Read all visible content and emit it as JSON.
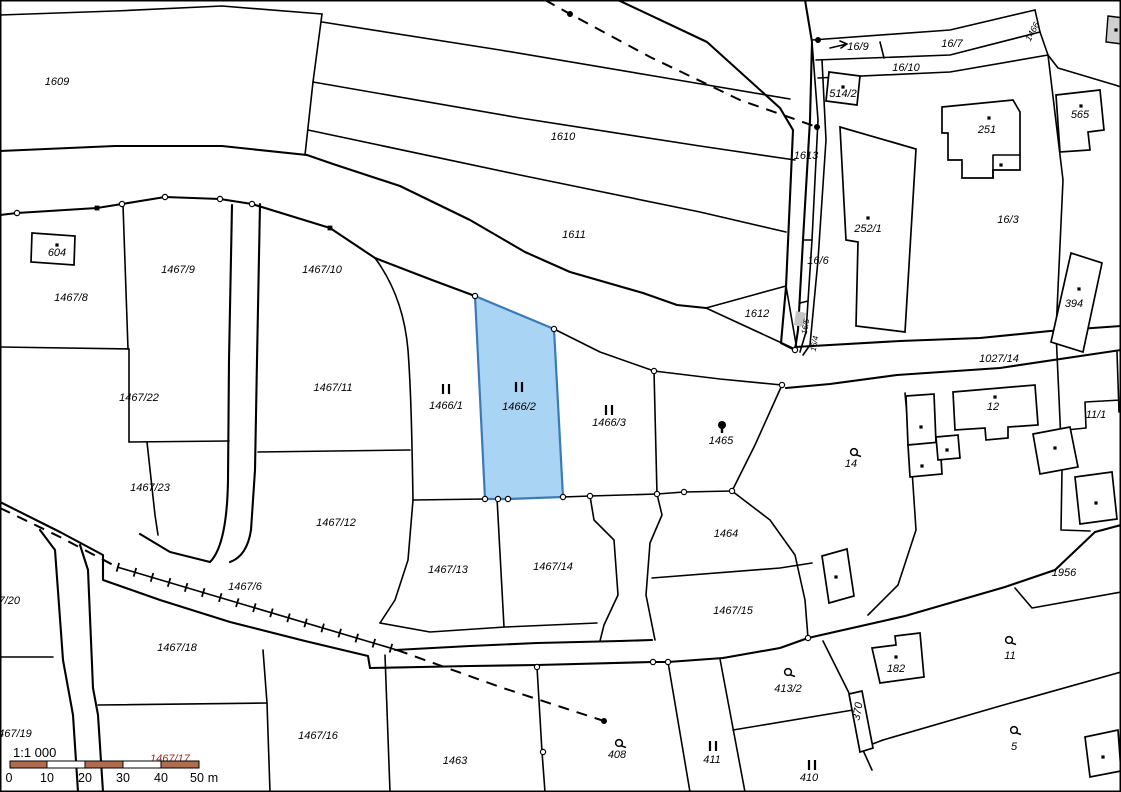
{
  "map": {
    "type": "cadastral-map",
    "background_color": "#ffffff",
    "line_color": "#000000",
    "highlight_parcel": {
      "label": "1466/2",
      "fill": "#a9d4f4",
      "stroke": "#3b7ab8"
    },
    "scale_bar": {
      "ratio_label": "1:1 000",
      "ticks": [
        "0",
        "10",
        "20",
        "30",
        "40",
        "50"
      ],
      "unit": "m",
      "bar_color": "#b26b4c",
      "bar_alt_color": "#ffffff",
      "hidden_label": "1467/17",
      "hidden_label_color": "#9b2c20"
    },
    "labels": [
      {
        "t": "1609",
        "x": 57,
        "y": 85
      },
      {
        "t": "1610",
        "x": 563,
        "y": 140
      },
      {
        "t": "1611",
        "x": 574,
        "y": 238
      },
      {
        "t": "16/9",
        "x": 858,
        "y": 50
      },
      {
        "t": "16/7",
        "x": 952,
        "y": 47
      },
      {
        "t": "16/10",
        "x": 906,
        "y": 71
      },
      {
        "t": "514/2",
        "x": 843,
        "y": 97
      },
      {
        "t": "1613",
        "x": 806,
        "y": 159
      },
      {
        "t": "252/1",
        "x": 868,
        "y": 232
      },
      {
        "t": "251",
        "x": 987,
        "y": 133
      },
      {
        "t": "565",
        "x": 1080,
        "y": 118
      },
      {
        "t": "16/3",
        "x": 1008,
        "y": 223
      },
      {
        "t": "16/6",
        "x": 818,
        "y": 264
      },
      {
        "t": "604",
        "x": 57,
        "y": 256
      },
      {
        "t": "1467/8",
        "x": 71,
        "y": 301
      },
      {
        "t": "1467/9",
        "x": 178,
        "y": 273
      },
      {
        "t": "1467/10",
        "x": 322,
        "y": 273
      },
      {
        "t": "1467/22",
        "x": 139,
        "y": 401
      },
      {
        "t": "1467/11",
        "x": 333,
        "y": 391
      },
      {
        "t": "1467/23",
        "x": 150,
        "y": 491
      },
      {
        "t": "1467/12",
        "x": 336,
        "y": 526
      },
      {
        "t": "1466/1",
        "x": 446,
        "y": 409
      },
      {
        "t": "1466/2",
        "x": 519,
        "y": 410
      },
      {
        "t": "1466/3",
        "x": 609,
        "y": 426
      },
      {
        "t": "1465",
        "x": 721,
        "y": 444
      },
      {
        "t": "1612",
        "x": 757,
        "y": 317
      },
      {
        "t": "1027/14",
        "x": 999,
        "y": 362
      },
      {
        "t": "12",
        "x": 993,
        "y": 410
      },
      {
        "t": "11/1",
        "x": 1096,
        "y": 418
      },
      {
        "t": "14",
        "x": 851,
        "y": 467
      },
      {
        "t": "394",
        "x": 1074,
        "y": 307
      },
      {
        "t": "1464",
        "x": 726,
        "y": 537
      },
      {
        "t": "1467/15",
        "x": 733,
        "y": 614
      },
      {
        "t": "1956",
        "x": 1064,
        "y": 576
      },
      {
        "t": "1467/6",
        "x": 245,
        "y": 590
      },
      {
        "t": "1467/18",
        "x": 177,
        "y": 651
      },
      {
        "t": "1467/20",
        "x": 20,
        "y": 604,
        "a": "end"
      },
      {
        "t": "1467/19",
        "x": -8,
        "y": 737,
        "a": "start"
      },
      {
        "t": "1467/16",
        "x": 318,
        "y": 739
      },
      {
        "t": "1467/13",
        "x": 448,
        "y": 573
      },
      {
        "t": "1467/14",
        "x": 553,
        "y": 570
      },
      {
        "t": "1463",
        "x": 455,
        "y": 764
      },
      {
        "t": "408",
        "x": 617,
        "y": 758
      },
      {
        "t": "411",
        "x": 712,
        "y": 763
      },
      {
        "t": "410",
        "x": 809,
        "y": 781
      },
      {
        "t": "413/2",
        "x": 788,
        "y": 692
      },
      {
        "t": "182",
        "x": 896,
        "y": 672
      },
      {
        "t": "11",
        "x": 1010,
        "y": 659
      },
      {
        "t": "5",
        "x": 1014,
        "y": 750
      },
      {
        "t": "370",
        "x": 861,
        "y": 712,
        "r": -80
      },
      {
        "t": "1466",
        "x": 1035,
        "y": 33,
        "r": -62,
        "c": "#8f8f8f",
        "s": 9
      },
      {
        "t": "16/5",
        "x": 808,
        "y": 327,
        "r": -80,
        "c": "#8f8f8f",
        "s": 8
      },
      {
        "t": "16/4",
        "x": 817,
        "y": 344,
        "r": -80,
        "c": "#8f8f8f",
        "s": 8
      }
    ],
    "symbols": {
      "grassland_two_bars": [
        [
          446,
          389
        ],
        [
          519,
          387
        ],
        [
          609,
          410
        ],
        [
          713,
          746
        ],
        [
          812,
          765
        ]
      ],
      "tree": [
        [
          854,
          452
        ],
        [
          619,
          743
        ],
        [
          788,
          672
        ],
        [
          1009,
          640
        ],
        [
          1014,
          730
        ]
      ],
      "tree_filled": [
        [
          722,
          427
        ]
      ],
      "building_dots": [
        [
          57,
          245
        ],
        [
          843,
          87
        ],
        [
          868,
          218
        ],
        [
          989,
          118
        ],
        [
          1001,
          165
        ],
        [
          1081,
          106
        ],
        [
          1079,
          289
        ],
        [
          896,
          657
        ],
        [
          836,
          577
        ],
        [
          921,
          427
        ],
        [
          947,
          450
        ],
        [
          922,
          466
        ],
        [
          995,
          397
        ],
        [
          1055,
          448
        ],
        [
          1096,
          503
        ],
        [
          1103,
          757
        ],
        [
          1116,
          30
        ]
      ],
      "line_dots": [
        [
          570,
          14
        ],
        [
          817,
          127
        ],
        [
          604,
          721
        ],
        [
          818,
          40
        ]
      ],
      "vertex_circles": [
        [
          17,
          213
        ],
        [
          122,
          204
        ],
        [
          165,
          197
        ],
        [
          220,
          199
        ],
        [
          252,
          204
        ],
        [
          475,
          296
        ],
        [
          554,
          329
        ],
        [
          563,
          497
        ],
        [
          485,
          499
        ],
        [
          498,
          499
        ],
        [
          508,
          499
        ],
        [
          590,
          496
        ],
        [
          654,
          371
        ],
        [
          657,
          494
        ],
        [
          684,
          492
        ],
        [
          732,
          491
        ],
        [
          782,
          385
        ],
        [
          795,
          350
        ],
        [
          537,
          667
        ],
        [
          653,
          662
        ],
        [
          668,
          662
        ],
        [
          543,
          752
        ],
        [
          808,
          638
        ]
      ],
      "vertex_squares": [
        [
          97,
          208
        ],
        [
          330,
          228
        ]
      ]
    }
  }
}
